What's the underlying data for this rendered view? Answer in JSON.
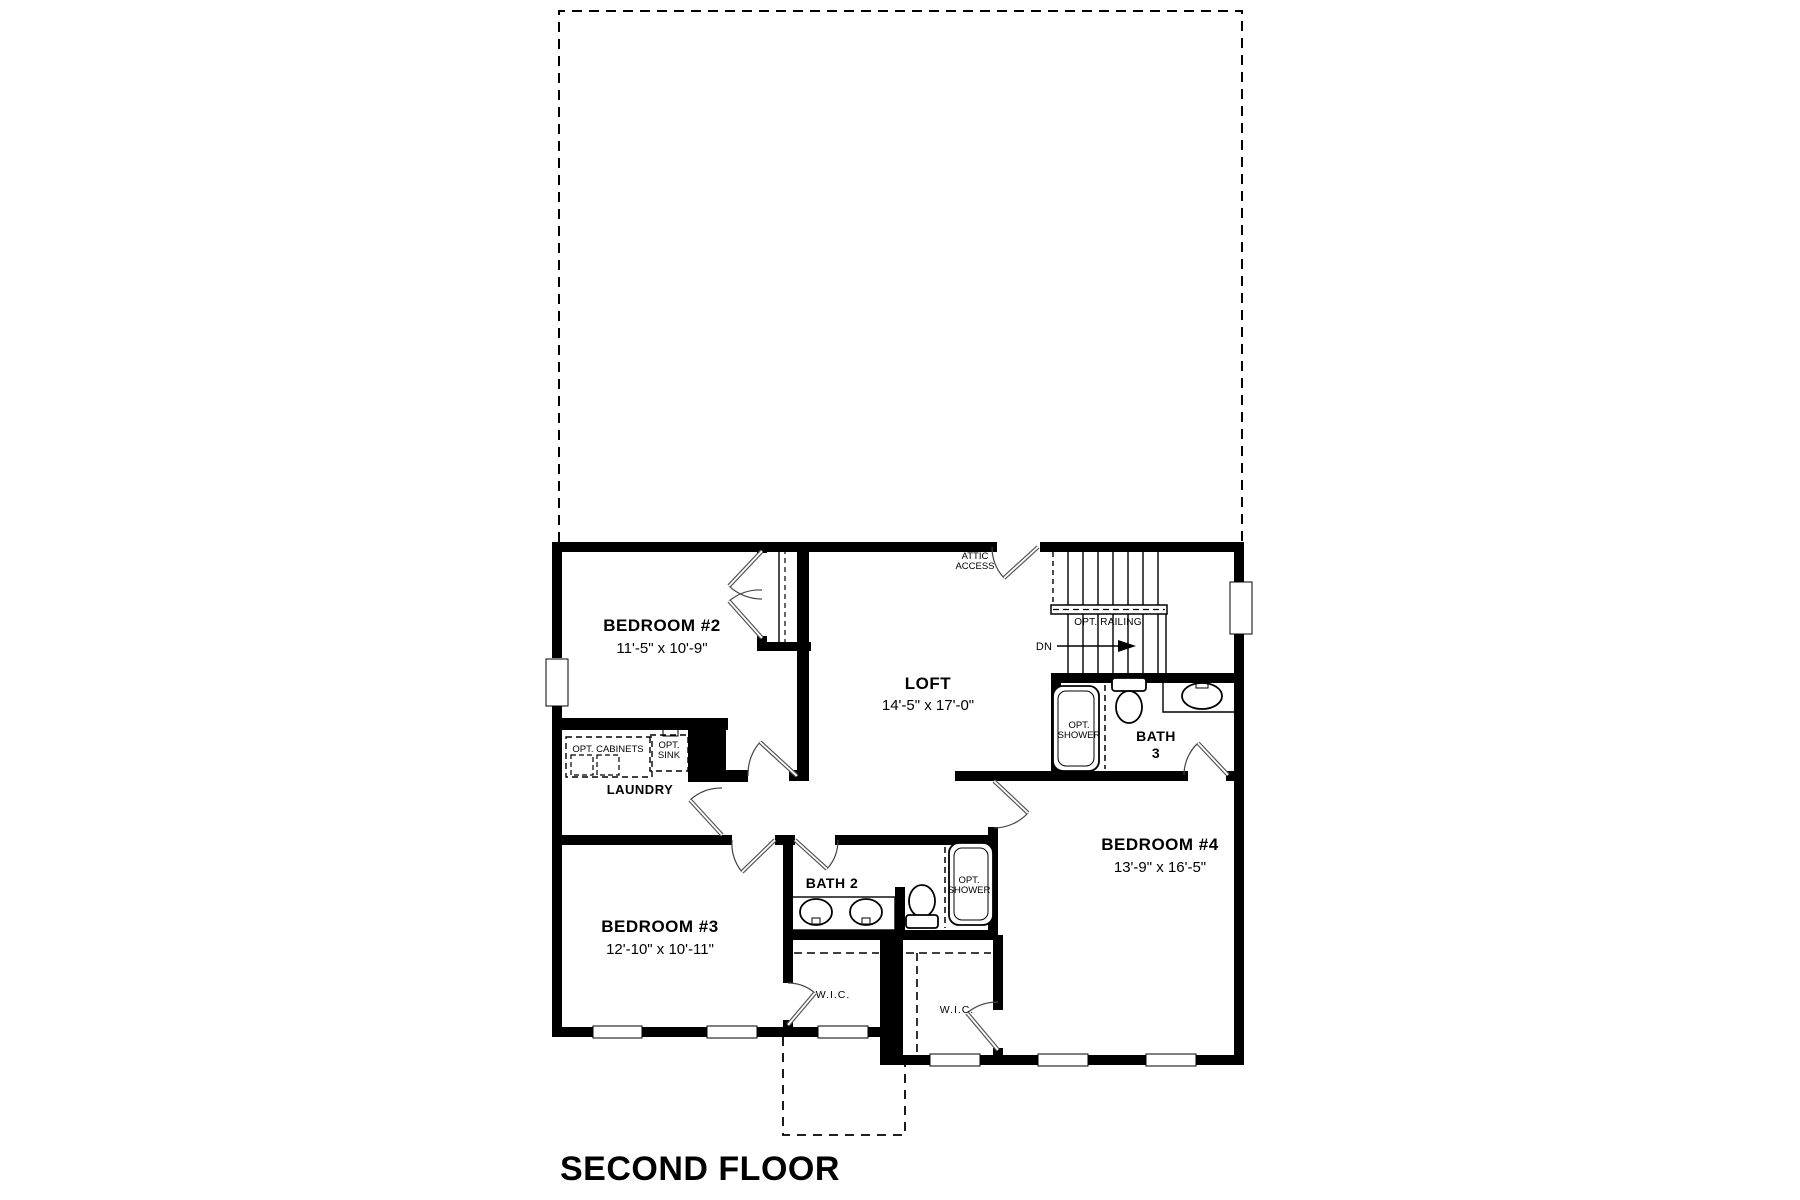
{
  "title": "SECOND FLOOR",
  "rooms": {
    "bedroom2": {
      "name": "BEDROOM #2",
      "dims": "11'-5\" x 10'-9\""
    },
    "bedroom3": {
      "name": "BEDROOM #3",
      "dims": "12'-10\" x 10'-11\""
    },
    "bedroom4": {
      "name": "BEDROOM #4",
      "dims": "13'-9\" x 16'-5\""
    },
    "loft": {
      "name": "LOFT",
      "dims": "14'-5\" x 17'-0\""
    },
    "bath2": {
      "name": "BATH 2"
    },
    "bath3": {
      "line1": "BATH",
      "line2": "3"
    },
    "laundry": {
      "name": "LAUNDRY"
    },
    "wic1": {
      "name": "W.I.C."
    },
    "wic2": {
      "name": "W.I.C."
    }
  },
  "annotations": {
    "attic1": "ATTIC",
    "attic2": "ACCESS",
    "opt_railing": "OPT. RAILING",
    "dn": "DN",
    "opt_cabinets": "OPT. CABINETS",
    "opt_sink1": "OPT.",
    "opt_sink2": "SINK",
    "opt_shower1": "OPT.",
    "opt_shower2": "SHOWER"
  },
  "colors": {
    "walls": "#000000",
    "background": "#ffffff",
    "door_leaf": "#555555",
    "arc": "#444444"
  }
}
